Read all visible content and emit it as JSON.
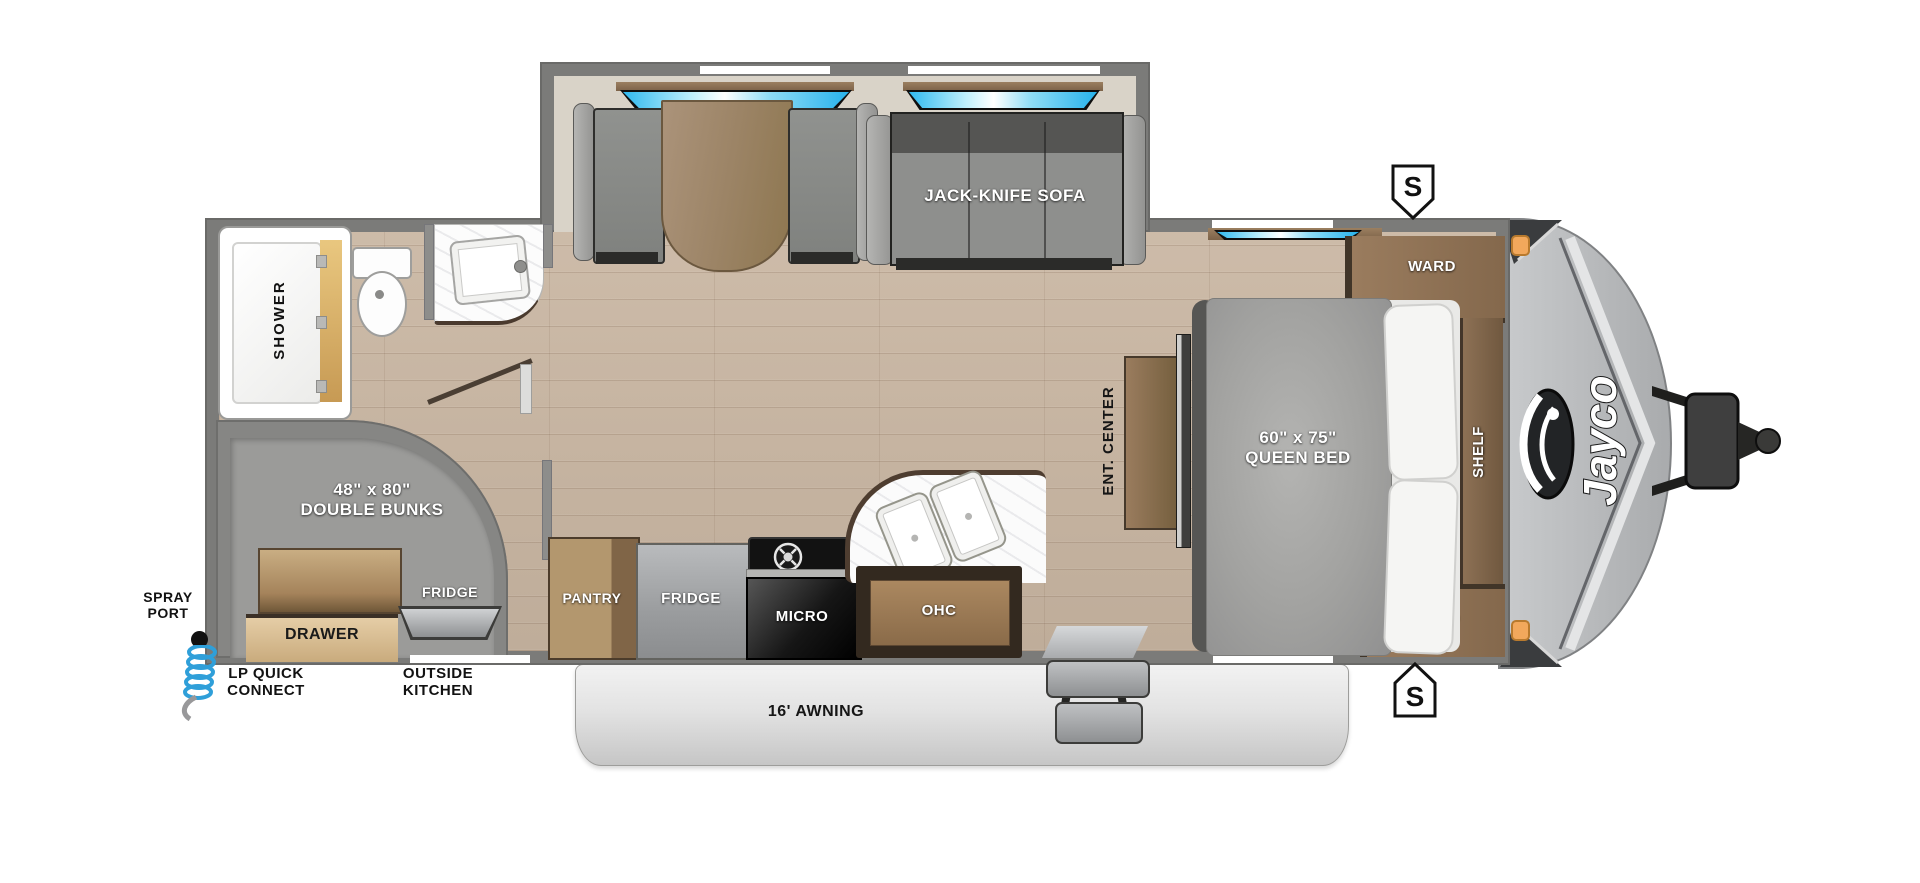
{
  "brand": "Jayco",
  "badges": {
    "top": "S",
    "bottom": "S"
  },
  "exterior": {
    "spray_port": "SPRAY PORT",
    "lp_quick_connect": "LP QUICK CONNECT",
    "outside_kitchen": "OUTSIDE KITCHEN",
    "awning": "16' AWNING"
  },
  "rooms": {
    "bath": {
      "shower": "SHOWER"
    },
    "living": {
      "sofa": "JACK-KNIFE SOFA"
    },
    "bunks": {
      "size": "48\" x 80\"",
      "name": "DOUBLE BUNKS",
      "drawer": "DRAWER",
      "fridge": "FRIDGE"
    },
    "kitchen": {
      "pantry": "PANTRY",
      "fridge": "FRIDGE",
      "micro": "MICRO",
      "ohc": "OHC"
    },
    "bedroom": {
      "size": "60\" x 75\"",
      "name": "QUEEN BED",
      "ward_top": "WARD",
      "ward_bottom": "WARD",
      "shelf": "SHELF",
      "ent_center": "ENT. CENTER"
    }
  },
  "colors": {
    "wall": "#7b7b79",
    "floor_wood": "#c9b6a2",
    "slide_interior": "#d9d3c8",
    "cabinet_wood": "#8a6b49",
    "window_blue": "#6fd0f2",
    "awning_gray": "#d9d9d9",
    "front_cap": "#b6b8ba",
    "marker_amber": "#f2a85c",
    "lp_hose_blue": "#2f9fd9"
  }
}
